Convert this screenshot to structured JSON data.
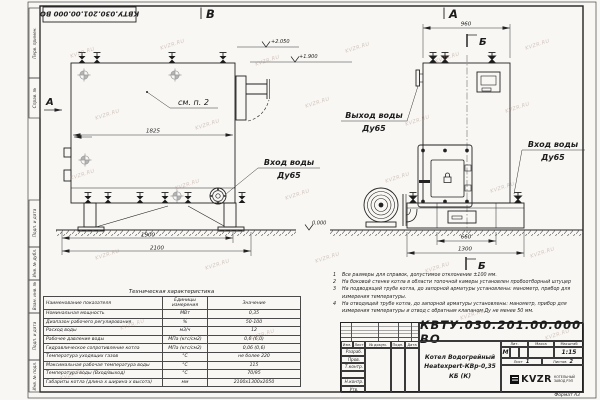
{
  "watermark": "KVZR.RU",
  "stamp_top": "КВТУ.030.201.00.000  ВО",
  "margin": {
    "labels": [
      "Перв. примен.",
      "Справ. №",
      "Подп. и дата",
      "Инв. № дубл.",
      "Взам. инв. №",
      "Подп. и дата",
      "Инв. № подл."
    ]
  },
  "drawing": {
    "view_b": {
      "label": "В",
      "view_arrow": "А",
      "note_ref": "см. п. 2",
      "dim_inner": "1825",
      "dim_base": "1900",
      "dim_total": "2100",
      "elev_top": "+2.050",
      "elev_body": "+1.900",
      "elev_zero": "0.000",
      "inlet_line1": "Вход воды",
      "inlet_line2": "Ду65"
    },
    "view_a": {
      "label": "А",
      "section": "Б",
      "section2": "Б",
      "dim_top": "960",
      "dim_furnace": "660",
      "dim_base": "1300",
      "outlet_line1": "Выход воды",
      "outlet_line2": "Ду65",
      "inlet_line1": "Вход воды",
      "inlet_line2": "Ду65"
    }
  },
  "notes": {
    "items": [
      {
        "num": "1",
        "text": "Все размеры для справок, допустимое отклонение ±100 мм."
      },
      {
        "num": "2",
        "text": "На боковой стенке котла в области топочной камеры установлен пробоотборный штуцер"
      },
      {
        "num": "3",
        "text": "На подводящей трубе котла, до запорной арматуры установлены: манометр, прибор для измерения температуры."
      },
      {
        "num": "4",
        "text": "На отводящей трубе котла, до запорной арматуры установлены: манометр, прибор для измерения температуры и отвод с обратным клапаном Ду не менее 50 мм."
      }
    ]
  },
  "tech_table": {
    "title": "Техническая характеристика",
    "headers": [
      "Наименование показателя",
      "Единицы измерения",
      "Значение"
    ],
    "rows": [
      [
        "Номинальная мощность",
        "МВт",
        "0,35"
      ],
      [
        "Диапазон рабочего регулирования",
        "%",
        "50-100"
      ],
      [
        "Расход воды",
        "м3/ч",
        "12"
      ],
      [
        "Рабочее давление воды",
        "МПа (кгс/см2)",
        "0,6 (6,0)"
      ],
      [
        "Гидравлическое сопротивление котла",
        "МПа (кгс/см2)",
        "0,06 (0,6)"
      ],
      [
        "Температура уходящих газов",
        "°С",
        "не более 220"
      ],
      [
        "Максимальная рабочая температура воды",
        "°С",
        "115"
      ],
      [
        "Температура воды (Вход/выход)",
        "°С",
        "70/95"
      ],
      [
        "Габариты котла (длина х ширина х высота)",
        "мм",
        "2100х1300х2050"
      ]
    ]
  },
  "title_block": {
    "designation": "КВТУ.030.201.00.000  ВО",
    "rev_cols": [
      "Изм.",
      "Лист",
      "№ докум.",
      "Подп.",
      "Дата"
    ],
    "roles": [
      "Разраб.",
      "Пров.",
      "Т.контр.",
      "Н.контр.",
      "Утв."
    ],
    "name_line1": "Котел Водогрейный",
    "name_line2": "Heatexpert-КВр-0,35 КБ (К)",
    "lit_label": "Лит.",
    "lit_value": "М",
    "mass_label": "Масса",
    "scale_label": "Масштаб",
    "scale_value": "1:15",
    "sheet_label": "Лист",
    "sheet_value": "1",
    "sheets_label": "Листов",
    "sheets_value": "2",
    "logo_text": "KVZR",
    "logo_sub1": "КОТЕЛЬНЫЙ",
    "logo_sub2": "ЗАВОД РЭП",
    "format_note": "Формат А3"
  }
}
